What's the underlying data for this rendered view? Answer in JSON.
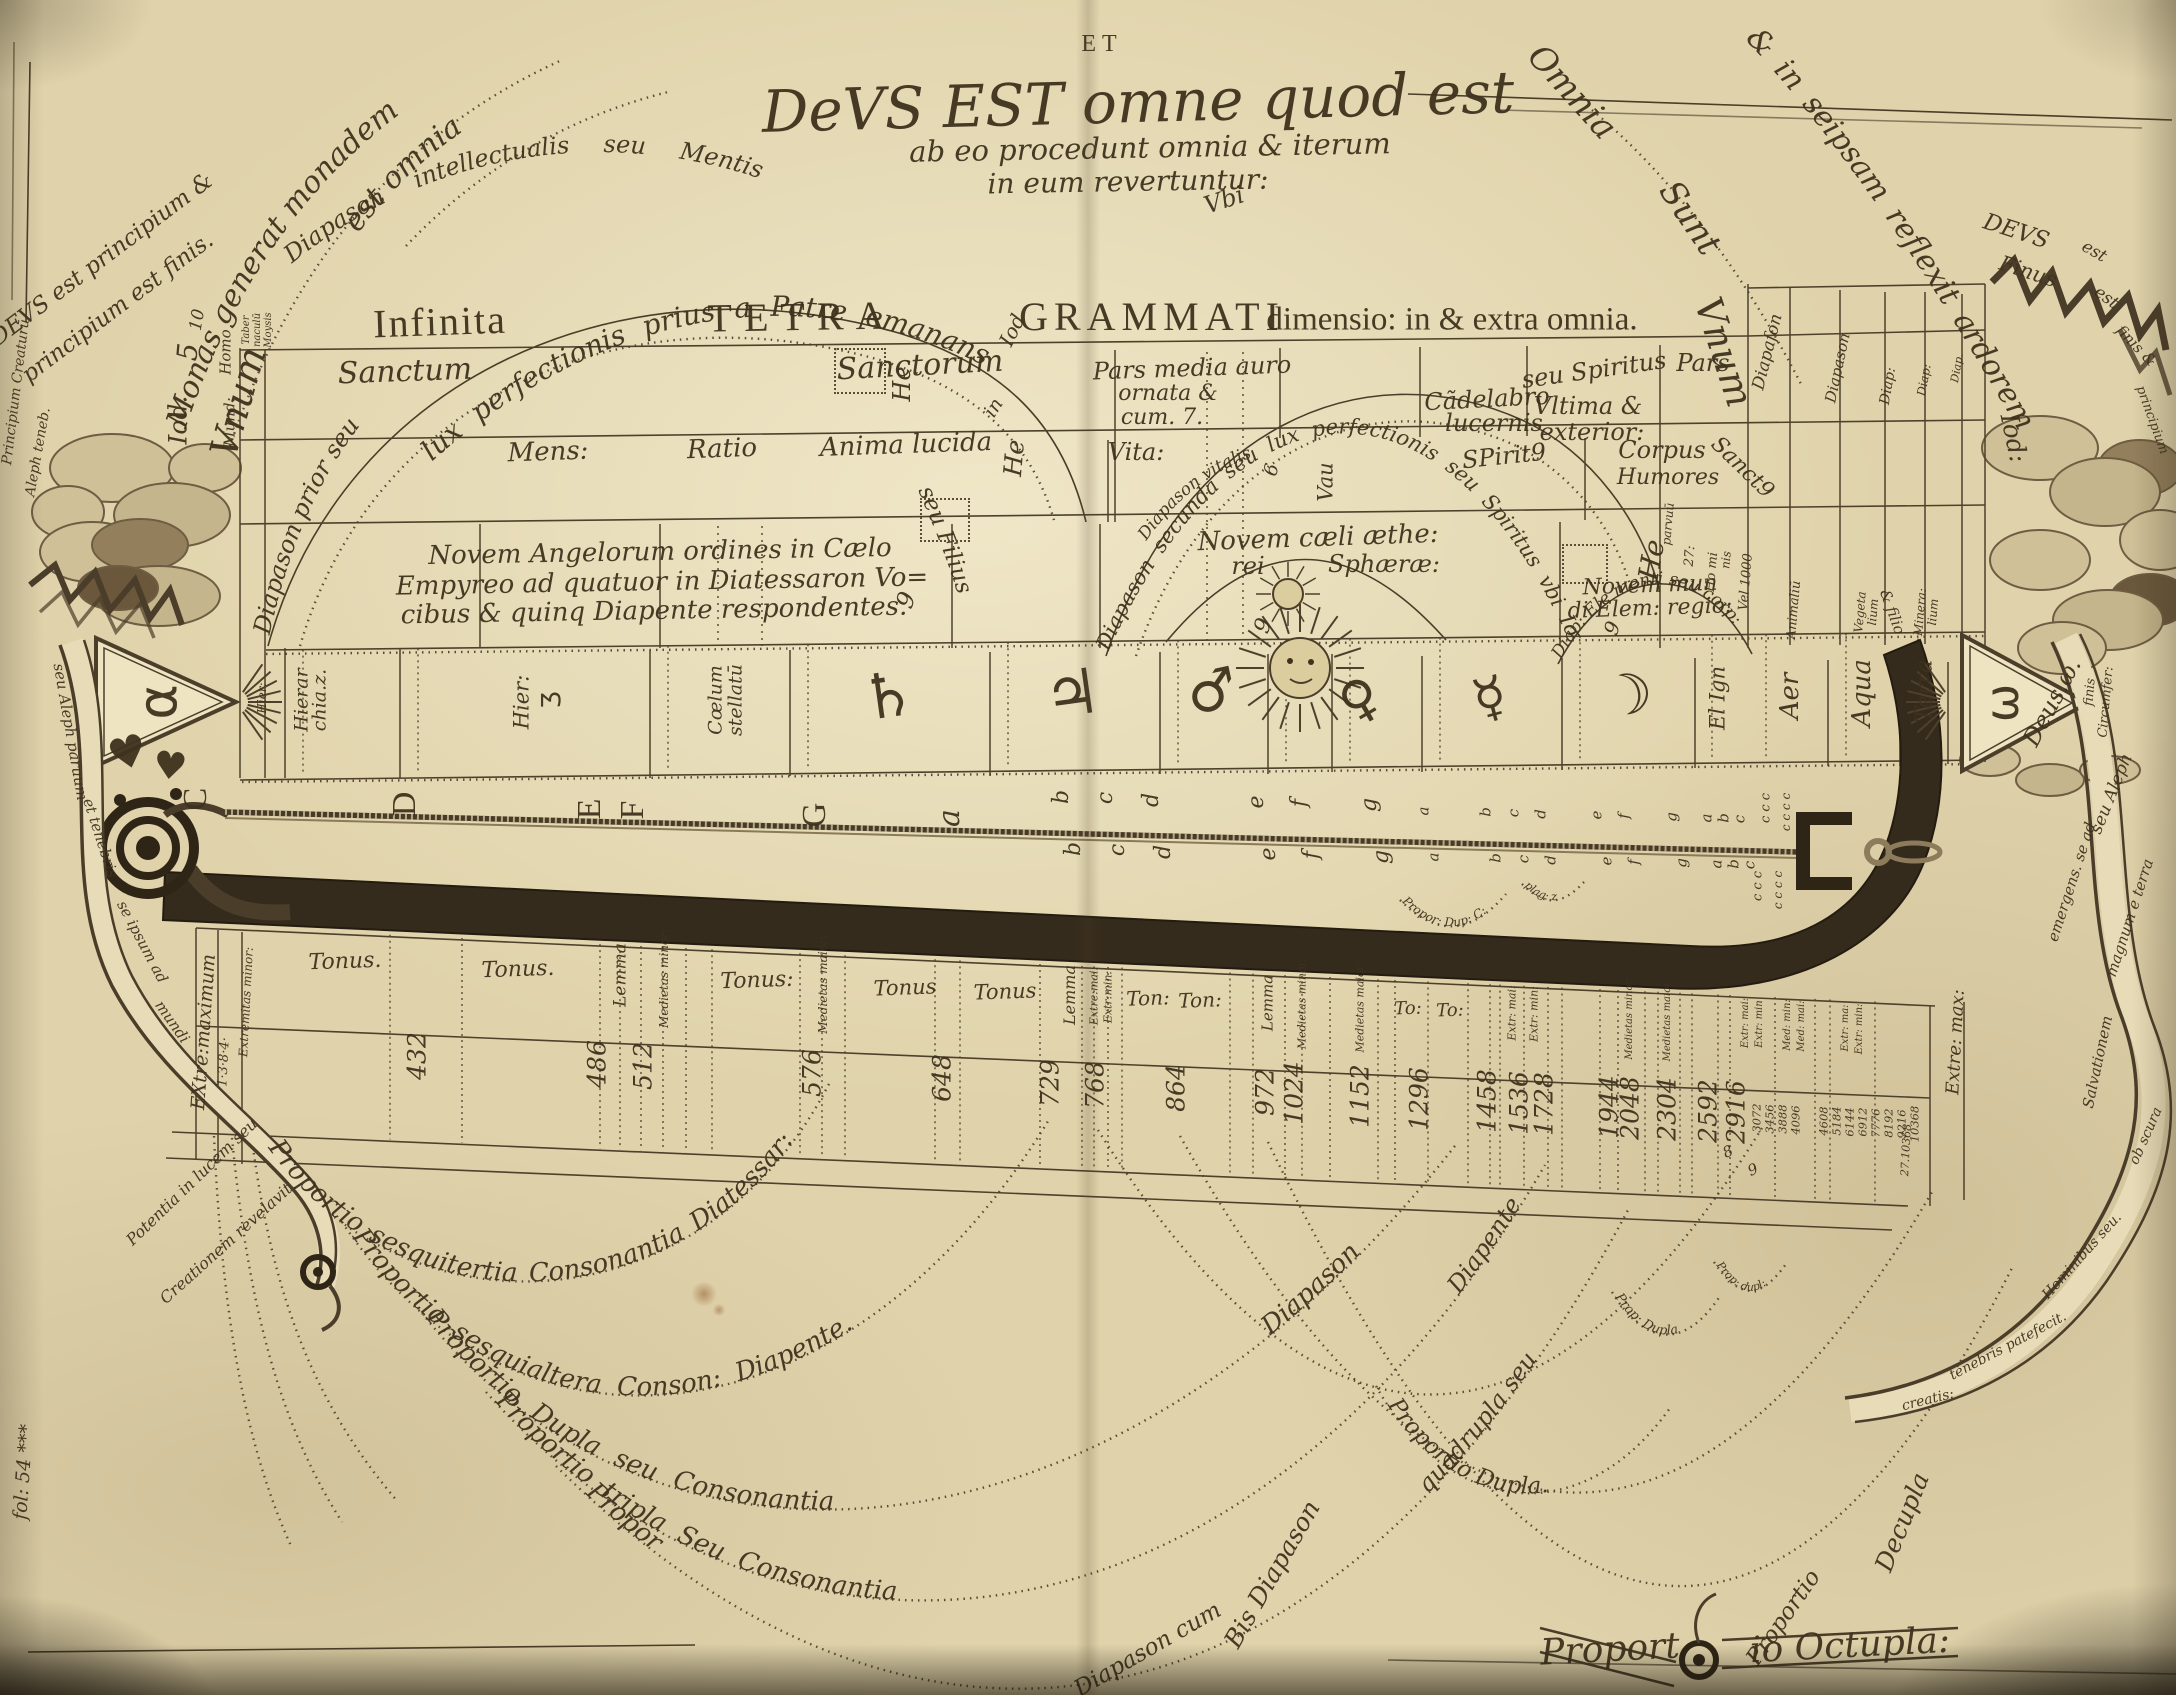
{
  "colors": {
    "paper": "#e0d3ab",
    "ink": "#3e3220",
    "band": "#352b1c",
    "cloud": "#cfc098"
  },
  "title": {
    "et": "ET",
    "main": "DeVS EST omne quod est",
    "line2": "ab eo procedunt omnia & iterum",
    "line3": "in eum revertuntur:",
    "vbi": "Vbi"
  },
  "header": {
    "infinita": "Infinita",
    "tetra": "TETRA",
    "iod": "Iod",
    "grammati": "GRAMMATI",
    "dimensio": "dimensio: in & extra omnia."
  },
  "curves": {
    "monas": "Monas generat monadem",
    "est_omnia": "est omnia",
    "diapason_intellectualis": "Diapason intellectualis seu Mentis",
    "reflexit": "& in seipsam reflexit ardorem",
    "lux_perfectionis": "lux perfectionis prius a Patre emanans",
    "diapason_prior": "Diapason prior seu",
    "seu_filius": "seu Filius",
    "diapason_secunda": "Diapason secunda seu lux perfectionis seu Spiritus vbi Iod",
    "diapason_vitalis": "Diapason vitalis",
    "diap_ele": "Diap: Ele menti seu corp:"
  },
  "corner_left": {
    "l1": "DEVS est principium &",
    "l2": "principium est finis.",
    "edge1": "Principium Creaturū",
    "edge2": "Aleph teneb.",
    "vnum": "Vnum",
    "iod": "Iod.",
    "ten": "10",
    "five": "5",
    "homo": "Homo",
    "mund": "Mund:",
    "taber": "Taber",
    "naculum": "naculū",
    "moysis": "Moysis"
  },
  "corner_right": {
    "omnia": "Omnia",
    "sunt": "Sunt",
    "deus": "DEVS",
    "finus": "Finus",
    "est1": "est",
    "est2": "est",
    "finis": "finis &",
    "principium": "principium",
    "vnum": "Vnum",
    "iod": "Iod:",
    "fin_c": "finis",
    "circumfer": "Circumfer:"
  },
  "table": {
    "row1": {
      "sanctum": "Sanctum",
      "sanctorum": "Sanctorum",
      "pars_media1": "Pars media auro",
      "pars_media2": "ornata &",
      "pars_media3": "cum. 7.",
      "candelabro1": "Cãdelabro",
      "candelabro2": "lucernis",
      "seu_spiritus": "seu Spiritus",
      "vltima1": "Vltima &",
      "vltima2": "exterior:",
      "pars": "Pars",
      "sanct": "Sanct9"
    },
    "row2": {
      "mens": "Mens:",
      "ratio": "Ratio",
      "anima": "Anima lucida",
      "vita": "Vita:",
      "spiritus": "SPirit9",
      "corpus": "Corpus",
      "humores": "Humores",
      "he1": "He",
      "in": "in",
      "he2": "He",
      "vau": "Vau",
      "six": "6"
    },
    "row3": {
      "angels1": "Novem Angelorum ordines in Cælo",
      "angels2": "Empyreo ad quatuor in Diatessaron Vo=",
      "angels3": "cibus & quinq Diapente respondentes.",
      "caeli1": "Novem cæli æthe:",
      "caeli2": "rei",
      "caeli3": "Sphæræ:",
      "elem1": "Novem mun",
      "elem2": "di Elem: regio:",
      "nine1": "9",
      "nine2": "9",
      "nine3": "9"
    },
    "planets": {
      "hier0": "Hier:",
      "hier1": "Hierar",
      "hier1b": "chia.z.",
      "hier2": "Hier:",
      "hier2_glyph": "Ʒ",
      "coelum1": "Cœlum",
      "coelum2": "stellatū",
      "saturn": "♄",
      "jupiter": "♃",
      "mars": "♂",
      "venus": "♀",
      "mercury": "☿",
      "luna": "☽",
      "el_ign": "El Ign",
      "aer": "Aer",
      "aqua": "Aqua",
      "terra": "Terra",
      "alpha": "α",
      "omega": "ω"
    },
    "right_cols": {
      "d1": "Diapaſon",
      "d2": "Diapason",
      "d3": "Diap:",
      "d4": "Diap:",
      "d5": "Diap.",
      "animalium": "Animaliū",
      "veg1": "Vegeta",
      "veg2": "lium",
      "min1": "Minera:",
      "min2": "lium",
      "he": "He",
      "parvum": "parvuū",
      "n27": "27:",
      "homi": "Ho mi",
      "nis": "nis",
      "vel": "Vel 1000",
      "filio": "& filio"
    }
  },
  "monochord": {
    "letters_big": [
      "C",
      "D",
      "E",
      "F",
      "G",
      "a"
    ],
    "letters_mid": [
      "b",
      "c",
      "d",
      "e",
      "f",
      "g"
    ],
    "letters_small": [
      "a",
      "b",
      "c",
      "d",
      "e",
      "f",
      "g",
      "a",
      "b",
      "c"
    ],
    "c3": "c c c",
    "c4": "c c c c",
    "propor_dup": "Propor: Dup: C:",
    "plag": "plag: z"
  },
  "intervals": [
    "Tonus.",
    "Tonus.",
    "Lemma",
    "Medietas minor:",
    "Tonus:",
    "Medietas maior:",
    "Tonus",
    "Tonus",
    "Lemma",
    "Extre:mai:",
    "Extr:min:",
    "Ton:",
    "Ton:",
    "Lemma",
    "Medietas minor.",
    "Medietas maior:",
    "To:",
    "To:",
    "Extr: mai:",
    "Extr: min:",
    "Medietas minor:",
    "Medietas maior:",
    "Extr: mai:",
    "Extr: min",
    "Med: min:",
    "Med: mai:",
    "Extr: ma:",
    "Extr: min:"
  ],
  "extremes": {
    "left1": "EXtre:maximum",
    "left2": "1·3·8·4·",
    "left3": "Extremitas minor:",
    "right": "Extre: max:",
    "last": "27.10368"
  },
  "numbers": [
    "432",
    "486",
    "512",
    "576",
    "648",
    "729",
    "768",
    "864",
    "972",
    "1024",
    "1152",
    "1296",
    "1458",
    "1536",
    "1728",
    "1944",
    "2048",
    "2304",
    "2592",
    "2916"
  ],
  "numbers_small": [
    "3072",
    "3456",
    "3888",
    "4096",
    "4608",
    "5184",
    "6144",
    "6912",
    "7776",
    "8192",
    "9216",
    "10368"
  ],
  "digits": {
    "eight": "8",
    "nine": "9"
  },
  "bottom": {
    "arc1": "Proportio sesquitertia Consonantia Diatessar:",
    "arc2": "Proportio sesquialtera Conson: Diapente.",
    "arc3": "Proportio Dupla seu Consonantia",
    "arc3b": "Diapason",
    "arc4": "Proportio tripla Seu Consonantia",
    "arc4b": "Diapason cum",
    "arc4c": "Diapente",
    "arc5": "Propor",
    "arc5b": "quadrupla seu",
    "bis": "Bis Diapason",
    "dupla_right": "Proportio Dupla.",
    "prop_dupla_small": "Prop: Dupla",
    "prop_dupla_tiny": "Prop: dupl:",
    "proportio_r": "Proportio",
    "decupla": "Decupla",
    "octupla1": "Proport",
    "octupla2": "io Octupla:"
  },
  "ribbon_left": [
    "seu Aleph paruum",
    "et tenebris",
    "se ipsum ad",
    "mundi",
    "Potentia in lucem seu",
    "Creationem revelavit.",
    "fol: 54 ***"
  ],
  "ribbon_right": [
    "Deus.ω.",
    "seu Aleph",
    "emergens. se ad",
    "magnum e terra",
    "Salvationem",
    "ob scura",
    "Hominibus seu.",
    "tenebris patefecit.",
    "creatis:"
  ],
  "glyphs": {
    "heart": "♥"
  }
}
